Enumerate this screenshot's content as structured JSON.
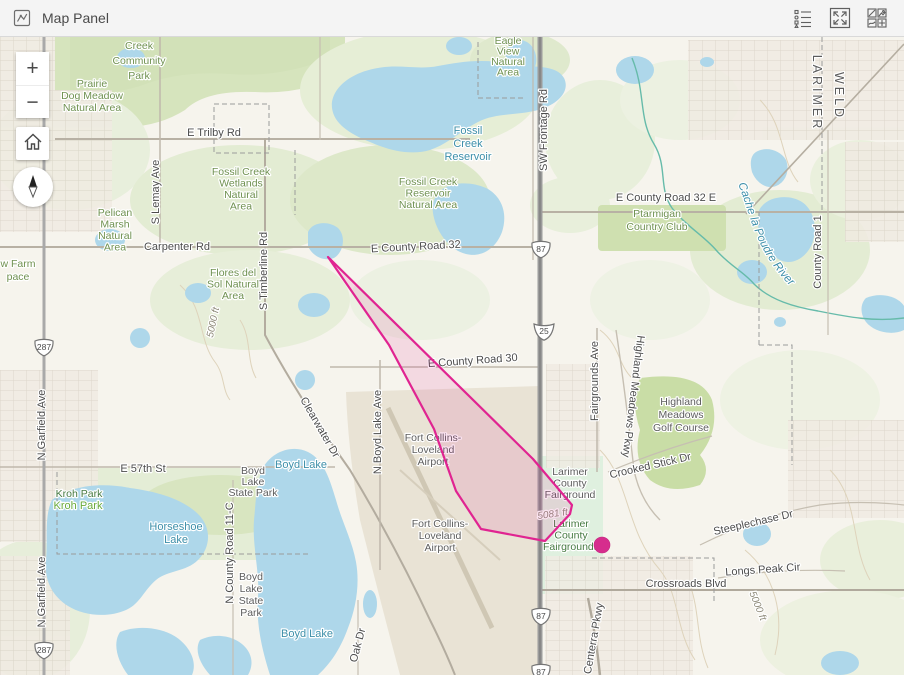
{
  "header": {
    "title": "Map Panel",
    "tools": [
      {
        "icon": "legend-icon"
      },
      {
        "icon": "expand-icon"
      },
      {
        "icon": "basemap-gallery-icon"
      }
    ],
    "panel_icon": "map-panel-icon"
  },
  "controls": {
    "zoom_in": "+",
    "zoom_out": "−",
    "home": "home-icon",
    "compass": "compass-needle-icon"
  },
  "colors": {
    "header_bg": "#f4f4f4",
    "header_text": "#4a4a4a",
    "icon": "#5f5f5f",
    "map_bg": "#f6f4ed",
    "water": "#aed7ea",
    "water_label": "#3d8fa9",
    "park_label": "#6f9150",
    "road_label": "#4d4d4d",
    "county_label": "#5c5c5c",
    "elev_label": "#8e8a79",
    "facility_label": "#5d5d5d",
    "polygon_stroke": "#e02491",
    "marker": "#d62d8d"
  },
  "overlay": {
    "polygon_points": "328,257 533,459 572,505 570,514 545,541 481,529 456,491 434,429 389,345",
    "marker": {
      "x": 602,
      "y": 545,
      "r": 8
    }
  },
  "map": {
    "river_label": {
      "text": "Cache la Poudre River",
      "path": "M738,184 C752,218 754,250 794,290"
    },
    "shields": [
      {
        "type": "us",
        "num": "287",
        "x": 44,
        "y": 347
      },
      {
        "type": "us",
        "num": "287",
        "x": 44,
        "y": 650
      },
      {
        "type": "us",
        "num": "87",
        "x": 541,
        "y": 249
      },
      {
        "type": "i",
        "num": "25",
        "x": 544,
        "y": 331
      },
      {
        "type": "us",
        "num": "87",
        "x": 541,
        "y": 616
      },
      {
        "type": "us",
        "num": "87",
        "x": 541,
        "y": 672
      }
    ],
    "labels": [
      {
        "lines": [
          "Creek",
          "Community",
          "Park"
        ],
        "x": 139,
        "y": 49,
        "c": "park",
        "lh": 15,
        "s": 11.5
      },
      {
        "lines": [
          "Prairie",
          "Dog Meadow",
          "Natural Area"
        ],
        "x": 92,
        "y": 87,
        "c": "park",
        "lh": 12
      },
      {
        "t": "E Trilby Rd",
        "x": 214,
        "y": 136,
        "c": "road"
      },
      {
        "lines": [
          "Fossil Creek",
          "Wetlands",
          "Natural",
          "Area"
        ],
        "x": 241,
        "y": 175,
        "c": "park",
        "lh": 11.5
      },
      {
        "lines": [
          "Fossil",
          "Creek",
          "Reservoir"
        ],
        "x": 468,
        "y": 134,
        "c": "water",
        "lh": 13
      },
      {
        "lines": [
          "Fossil Creek",
          "Reservoir",
          "Natural Area"
        ],
        "x": 428,
        "y": 185,
        "c": "park",
        "lh": 11.5
      },
      {
        "lines": [
          "Eagle",
          "View",
          "Natural",
          "Area"
        ],
        "x": 508,
        "y": 44,
        "c": "park",
        "lh": 10.5,
        "s": 10
      },
      {
        "t": "SW Frontage Rd",
        "x": 547,
        "y": 130,
        "r": -90,
        "c": "road"
      },
      {
        "t": "E County Road 32",
        "x": 416,
        "y": 250,
        "r": -3,
        "c": "road"
      },
      {
        "t": "E County Road 32 E",
        "x": 666,
        "y": 201,
        "c": "road"
      },
      {
        "lines": [
          "Ptarmigan",
          "Country Club"
        ],
        "x": 657,
        "y": 217,
        "c": "park",
        "lh": 13,
        "s": 11
      },
      {
        "t": "LARIMER",
        "x": 813,
        "y": 93,
        "r": 90,
        "c": "county"
      },
      {
        "t": "WELD",
        "x": 835,
        "y": 96,
        "r": 90,
        "c": "county"
      },
      {
        "t": "County Road 1",
        "x": 821,
        "y": 252,
        "r": -90,
        "c": "road",
        "s": 10.5
      },
      {
        "t": "E County Road 30",
        "x": 473,
        "y": 364,
        "r": -4,
        "c": "road"
      },
      {
        "t": "Fairgrounds Ave",
        "x": 598,
        "y": 381,
        "r": -90,
        "c": "road"
      },
      {
        "t": "Highland Meadows Pkwy",
        "x": 630,
        "y": 396,
        "r": 97,
        "c": "road",
        "s": 10.5
      },
      {
        "lines": [
          "Highland",
          "Meadows",
          "Golf Course"
        ],
        "x": 681,
        "y": 405,
        "c": "facility",
        "lh": 13,
        "s": 11
      },
      {
        "t": "Crooked Stick Dr",
        "x": 651,
        "y": 469,
        "r": -13,
        "c": "road",
        "s": 10.5
      },
      {
        "lines": [
          "Larimer",
          "County",
          "Fairground"
        ],
        "x": 570,
        "y": 475,
        "c": "facility",
        "lh": 11.5
      },
      {
        "t": "5081 ft",
        "x": 553,
        "y": 517,
        "r": -8,
        "c": "elev",
        "s": 10.5
      },
      {
        "lines": [
          "Larimer",
          "County",
          "Fairgrounds"
        ],
        "x": 571,
        "y": 527,
        "c": "park-dark",
        "lh": 11.5
      },
      {
        "lines": [
          "Fort Collins-",
          "Loveland",
          "Airport"
        ],
        "x": 433,
        "y": 441,
        "c": "facility",
        "lh": 12
      },
      {
        "lines": [
          "Fort Collins-",
          "Loveland",
          "Airport"
        ],
        "x": 440,
        "y": 527,
        "c": "facility",
        "lh": 12
      },
      {
        "t": "N Boyd Lake Ave",
        "x": 381,
        "y": 432,
        "r": -90,
        "c": "road"
      },
      {
        "t": "Clearwater Dr",
        "x": 317,
        "y": 429,
        "r": 60,
        "c": "road",
        "s": 10
      },
      {
        "t": "Boyd Lake",
        "x": 301,
        "y": 468,
        "c": "water"
      },
      {
        "lines": [
          "Boyd",
          "Lake",
          "State Park"
        ],
        "x": 253,
        "y": 474,
        "c": "facility",
        "lh": 11,
        "s": 10
      },
      {
        "t": "E 57th St",
        "x": 143,
        "y": 472,
        "c": "road"
      },
      {
        "t": "Kroh Park",
        "x": 79,
        "y": 497,
        "c": "park-dark",
        "s": 11
      },
      {
        "t": "Kroh Park",
        "x": 78,
        "y": 509,
        "c": "park-bright",
        "s": 11
      },
      {
        "lines": [
          "Horseshoe",
          "Lake"
        ],
        "x": 176,
        "y": 530,
        "c": "water",
        "lh": 13
      },
      {
        "t": "N County Road 11-C",
        "x": 233,
        "y": 553,
        "r": -90,
        "c": "road",
        "s": 10
      },
      {
        "lines": [
          "Boyd",
          "Lake",
          "State",
          "Park"
        ],
        "x": 251,
        "y": 580,
        "c": "facility",
        "lh": 12,
        "s": 10
      },
      {
        "t": "Boyd Lake",
        "x": 307,
        "y": 637,
        "c": "water"
      },
      {
        "t": "N Garfield Ave",
        "x": 45,
        "y": 425,
        "r": -90,
        "c": "road"
      },
      {
        "t": "N Garfield Ave",
        "x": 45,
        "y": 592,
        "r": -90,
        "c": "road"
      },
      {
        "lines": [
          "w Farm",
          "pace"
        ],
        "x": 18,
        "y": 267,
        "c": "park",
        "lh": 13,
        "s": 11
      },
      {
        "lines": [
          "Pelican",
          "Marsh",
          "Natural",
          "Area"
        ],
        "x": 115,
        "y": 216,
        "c": "park",
        "lh": 11.5
      },
      {
        "t": "S Lemay Ave",
        "x": 159,
        "y": 192,
        "r": -90,
        "c": "road"
      },
      {
        "t": "Carpenter Rd",
        "x": 177,
        "y": 250,
        "c": "road"
      },
      {
        "t": "S Timberline Rd",
        "x": 267,
        "y": 271,
        "r": -90,
        "c": "road"
      },
      {
        "lines": [
          "Flores del",
          "Sol Natural",
          "Area"
        ],
        "x": 233,
        "y": 276,
        "c": "park",
        "lh": 11.5
      },
      {
        "t": "5000 ft",
        "x": 216,
        "y": 323,
        "r": -78,
        "c": "elev"
      },
      {
        "t": "5000 ft",
        "x": 755,
        "y": 607,
        "r": 68,
        "c": "elev"
      },
      {
        "t": "Crossroads Blvd",
        "x": 686,
        "y": 587,
        "c": "road"
      },
      {
        "t": "Longs Peak Cir",
        "x": 763,
        "y": 573,
        "r": -4,
        "c": "road"
      },
      {
        "t": "Steeplechase Dr",
        "x": 754,
        "y": 526,
        "r": -13,
        "c": "road"
      },
      {
        "t": "Centerra Pkwy",
        "x": 597,
        "y": 639,
        "r": -80,
        "c": "road"
      },
      {
        "t": "Oak Dr",
        "x": 361,
        "y": 646,
        "r": -75,
        "c": "road",
        "s": 10
      }
    ]
  }
}
